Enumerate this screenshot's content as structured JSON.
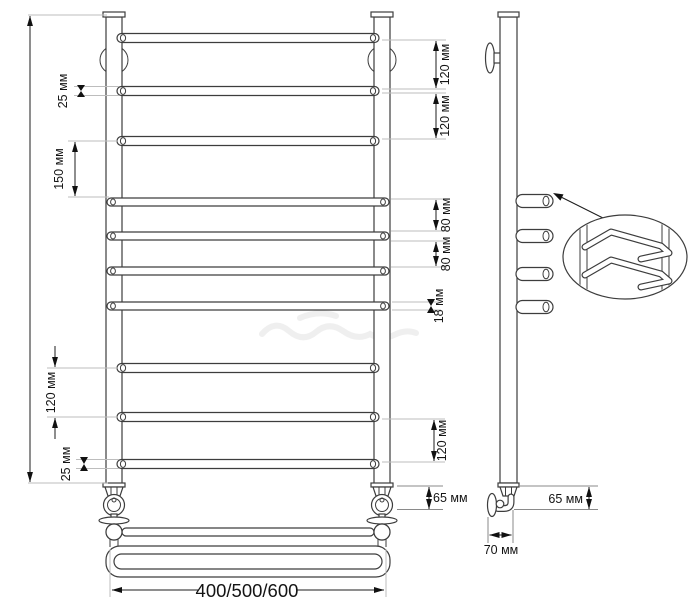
{
  "title": "Ladder towel rail technical drawing",
  "colors": {
    "background": "#ffffff",
    "outline": "#3d3d3d",
    "dimension_line": "#1c1c1c",
    "extension_line": "#bdbdbd",
    "label_text": "#141414"
  },
  "front": {
    "dims": {
      "tube_dia_top": "25 мм",
      "top_gap_1": "120 мм",
      "top_gap_2": "120 мм",
      "section_gap": "150 мм",
      "mid_gap_1": "80 мм",
      "mid_gap_2": "80 мм",
      "tube_dia_mid": "18 мм",
      "lower_gap_left": "120 мм",
      "lower_gap_right": "120 мм",
      "tube_dia_bottom": "25 мм",
      "valve_height": "65 мм",
      "width_options": "400/500/600"
    }
  },
  "side": {
    "dims": {
      "valve_height": "65 мм",
      "wall_offset": "70 мм"
    }
  }
}
